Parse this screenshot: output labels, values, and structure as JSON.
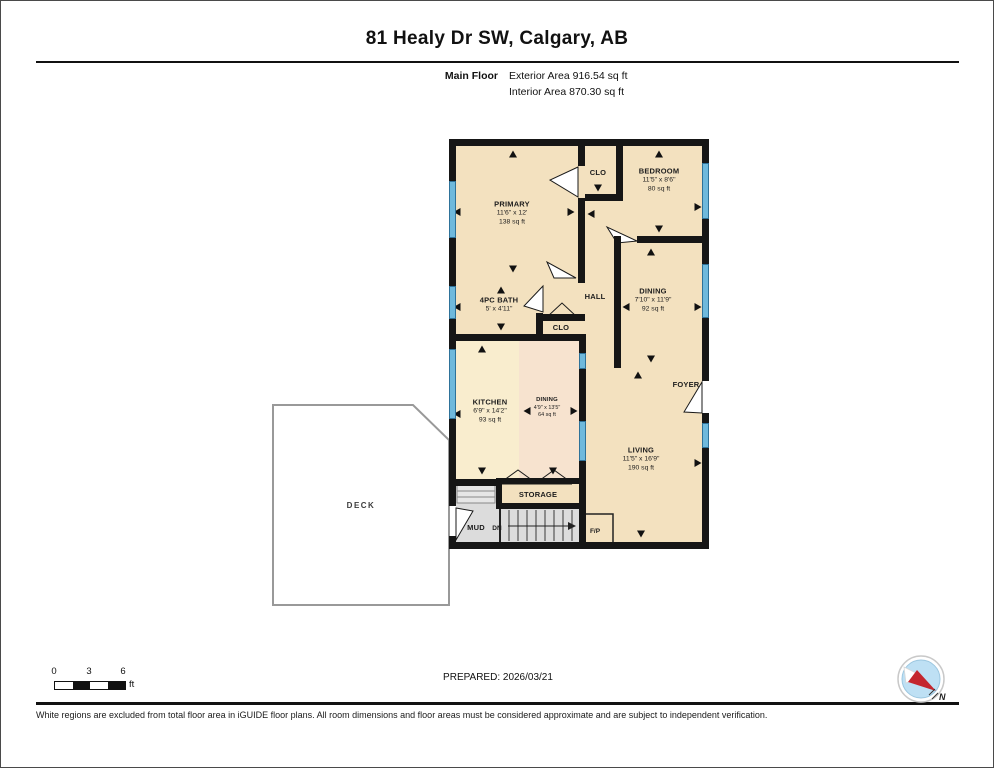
{
  "header": {
    "title": "81 Healy Dr SW, Calgary, AB",
    "floor_label": "Main Floor",
    "exterior_area": "Exterior Area 916.54 sq ft",
    "interior_area": "Interior Area 870.30 sq ft"
  },
  "rooms": {
    "primary": {
      "name": "PRIMARY",
      "dims": "11'6\" x 12'",
      "area": "138 sq ft"
    },
    "clo_top": {
      "name": "CLO"
    },
    "bedroom": {
      "name": "BEDROOM",
      "dims": "11'5\" x 8'6\"",
      "area": "80 sq ft"
    },
    "bath": {
      "name": "4PC BATH",
      "dims": "5' x 4'11\""
    },
    "hall": {
      "name": "HALL"
    },
    "clo_hall": {
      "name": "CLO"
    },
    "dining": {
      "name": "DINING",
      "dims": "7'10\" x 11'9\"",
      "area": "92 sq ft"
    },
    "kitchen": {
      "name": "KITCHEN",
      "dims": "6'9\" x 14'2\"",
      "area": "93 sq ft"
    },
    "nook": {
      "name": "DINING",
      "dims": "4'9\" x 13'5\"",
      "area": "64 sq ft"
    },
    "foyer": {
      "name": "FOYER"
    },
    "living": {
      "name": "LIVING",
      "dims": "11'5\" x 16'9\"",
      "area": "190 sq ft"
    },
    "storage": {
      "name": "STORAGE"
    },
    "mud": {
      "name": "MUD"
    },
    "stairs": {
      "label": "DN"
    },
    "fireplace": {
      "name": "F/P"
    },
    "deck": {
      "name": "DECK"
    }
  },
  "scale_bar": {
    "tick0": "0",
    "tick1": "3",
    "tick2": "6",
    "unit": "ft"
  },
  "footer": {
    "prepared": "PREPARED: 2026/03/21",
    "disclaimer": "White regions are excluded from total floor area in iGUIDE floor plans. All room dimensions and floor areas must be considered approximate and are subject to independent verification.",
    "compass_label": "N"
  },
  "colors": {
    "wall": "#161616",
    "floor_base": "#F3E1BF",
    "floor_kitchen": "#F9EDCE",
    "floor_nook": "#F7E3CF",
    "floor_gray": "#DCDCDC",
    "window_fill": "#6FB9DC",
    "window_border": "#2E7299",
    "deck_border": "#999999",
    "compass_blue": "#BEE0F4",
    "compass_red": "#C4262E"
  }
}
